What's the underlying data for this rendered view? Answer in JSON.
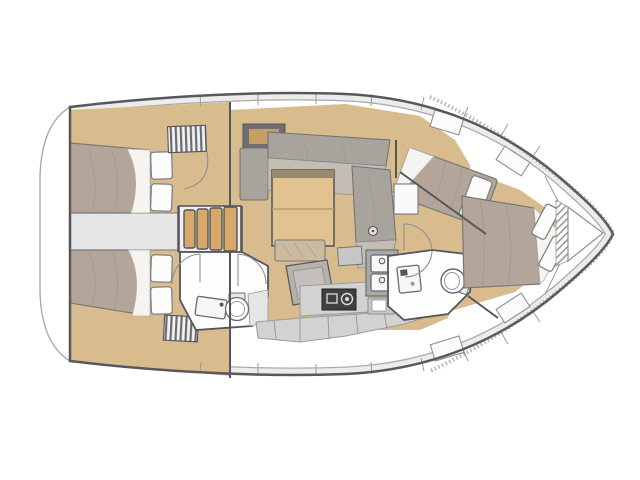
{
  "meta": {
    "diagram_type": "sailing-yacht-interior-floor-plan",
    "view": "top-down",
    "orientation": {
      "bow": "right",
      "stern": "left"
    }
  },
  "colors": {
    "floor": "#d9bc8e",
    "wood": "#d8a869",
    "table": "#e2c28f",
    "mattress": "#b3a599",
    "sheet": "#f6f4f1",
    "pillow": "#fcfcfb",
    "settee": "#a8a39c",
    "setteeLight": "#c3bdb4",
    "deck": "#ececec",
    "counter": "#d2d2d2",
    "counterDark": "#a8a9ab",
    "appliance": "#3f4042",
    "wall": "#55565a",
    "hullStroke": "#57585a",
    "line": "#a9aaac"
  },
  "features": [
    "swim-platform",
    "hull-outline",
    "side-deck",
    "aft-port-cabin",
    "aft-starboard-cabin",
    "engine-compartment",
    "companionway-steps",
    "louvered-locker-port",
    "louvered-locker-starboard",
    "salon",
    "l-shaped-settee",
    "salon-table",
    "entry-console",
    "nav-seat",
    "chart-table",
    "mast-post",
    "aft-head",
    "aft-head-sink",
    "aft-head-toilet",
    "shower-panel",
    "galley",
    "stove",
    "double-sink",
    "icebox",
    "galley-cabinets",
    "forward-head",
    "forward-head-sink",
    "forward-head-toilet",
    "forward-port-berth",
    "owner-cabin-berth",
    "pillows",
    "bow-anchor-locker",
    "chain-hatch",
    "door-swing-arcs",
    "deck-hatches"
  ]
}
